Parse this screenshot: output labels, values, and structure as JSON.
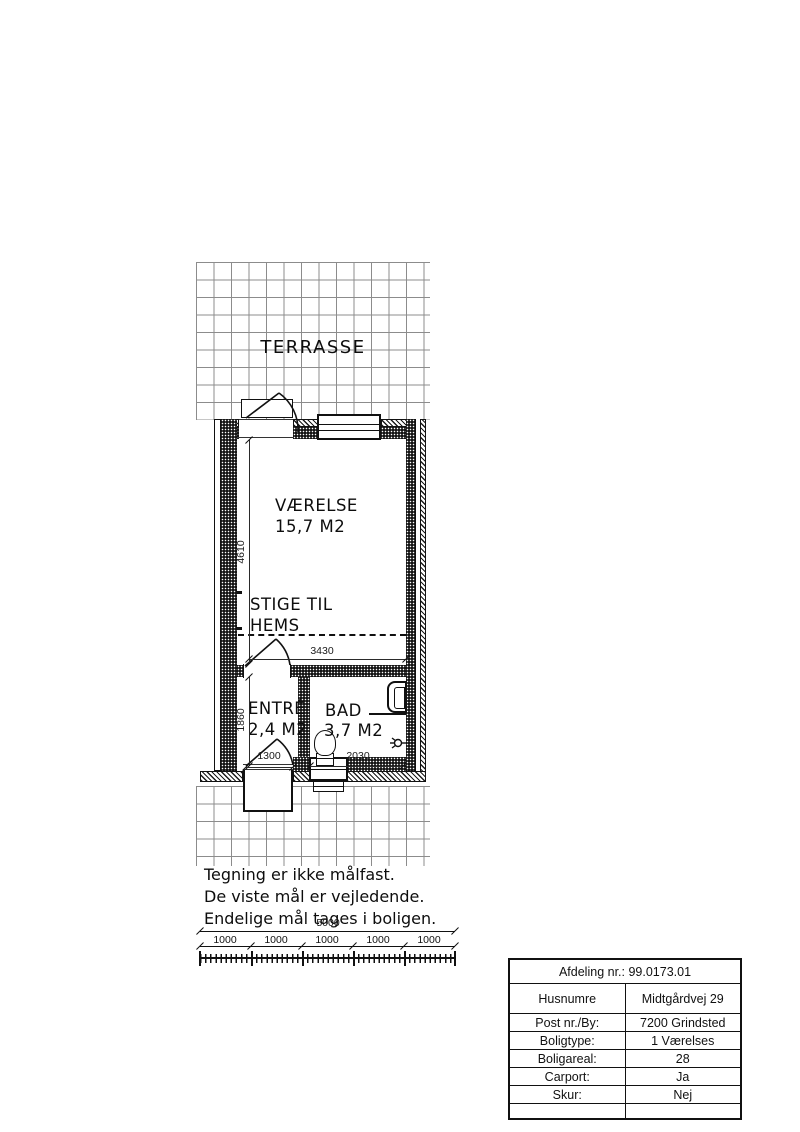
{
  "plan": {
    "terrace_label": "TERRASSE",
    "rooms": {
      "vaerelse": {
        "name": "VÆRELSE",
        "area": "15,7 M2"
      },
      "entre": {
        "name": "ENTRÉ",
        "area": "2,4 M2"
      },
      "bad": {
        "name": "BAD",
        "area": "3,7 M2"
      }
    },
    "loft_note_line1": "STIGE TIL",
    "loft_note_line2": "HEMS",
    "dimensions": {
      "room_depth": "4610",
      "room_width": "3430",
      "entry_depth": "1860",
      "entry_width": "1300",
      "bath_width": "2030"
    }
  },
  "notes": {
    "line1": "Tegning er ikke målfast.",
    "line2": "De viste mål er vejledende.",
    "line3": "Endelige mål tages i boligen."
  },
  "scalebar": {
    "total": "5000",
    "segments": [
      "1000",
      "1000",
      "1000",
      "1000",
      "1000"
    ]
  },
  "info_table": {
    "header": "Afdeling nr.: 99.0173.01",
    "rows": [
      {
        "label": "Husnumre",
        "value": "Midtgårdvej  29"
      },
      {
        "label": "Post nr./By:",
        "value": "7200 Grindsted"
      },
      {
        "label": "Boligtype:",
        "value": "1 Værelses"
      },
      {
        "label": "Boligareal:",
        "value": "28"
      },
      {
        "label": "Carport:",
        "value": "Ja"
      },
      {
        "label": "Skur:",
        "value": "Nej"
      },
      {
        "label": "",
        "value": ""
      }
    ]
  }
}
